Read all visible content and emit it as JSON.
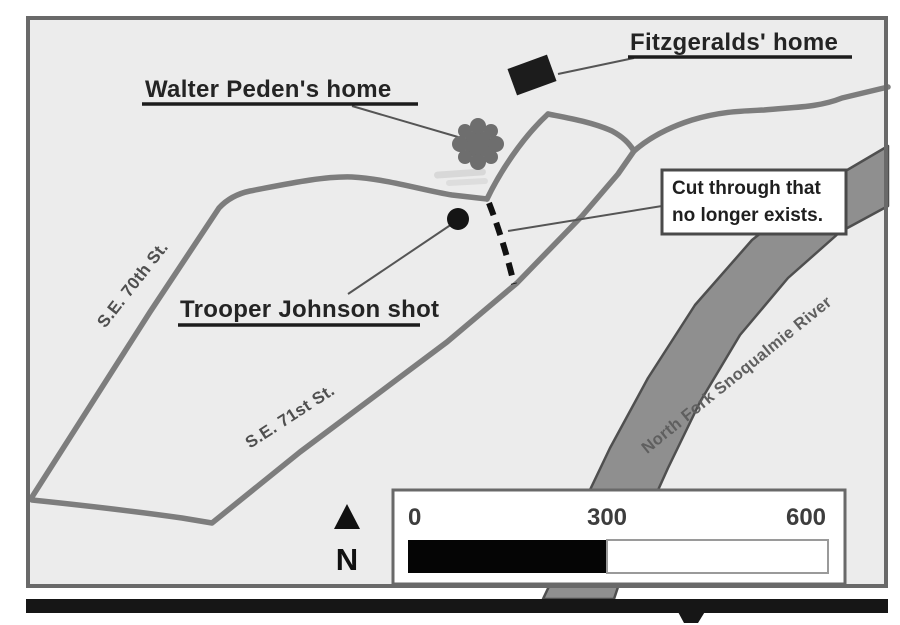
{
  "map": {
    "labels": {
      "walter_peden_home": "Walter Peden's home",
      "fitzgeralds_home": "Fitzgeralds' home",
      "trooper_johnson_shot": "Trooper Johnson shot",
      "cut_through_line1": "Cut through that",
      "cut_through_line2": "no longer exists.",
      "street_70th": "S.E. 70th St.",
      "street_71st": "S.E. 71st St.",
      "river": "North Fork Snoqualmie River"
    },
    "markers": {
      "fitzgeralds_house": "house-marker-icon",
      "peden_home": "splat-marker-icon",
      "shooting_site": "dot-marker-icon"
    },
    "north_arrow": {
      "letter": "N"
    },
    "scale_bar": {
      "ticks": [
        "0",
        "300",
        "600"
      ]
    },
    "colors": {
      "map_background": "#ececec",
      "border": "#696969",
      "road": "#7d7d7d",
      "river_fill": "#8f8f8f",
      "river_edge": "#4f4f4f",
      "label_text": "#242424",
      "bottom_bar": "#161616"
    }
  }
}
